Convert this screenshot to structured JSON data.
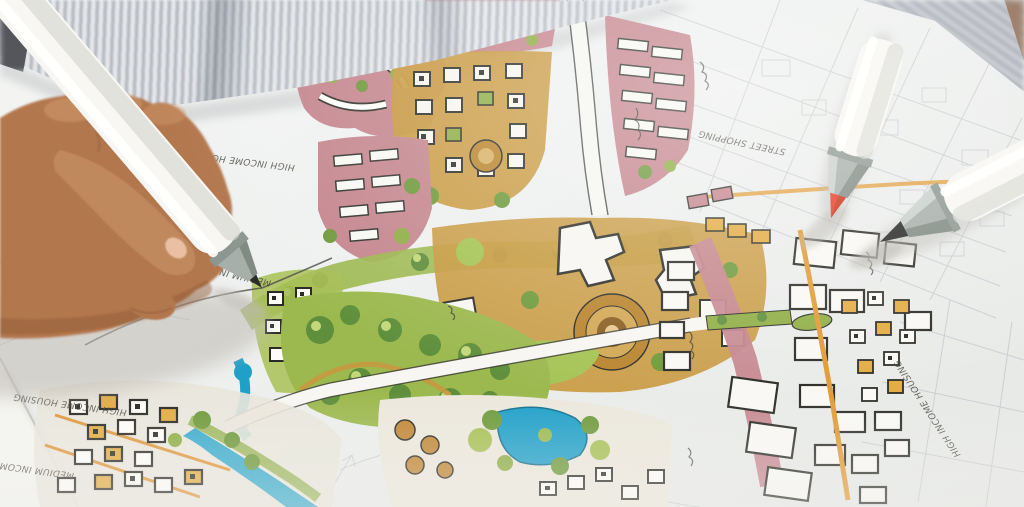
{
  "photo": {
    "scene": "hand sketching with a marker on a colorful hand-drawn urban master plan",
    "labels": [
      {
        "text": "HIGH INCOME HOUSING",
        "location": "left, under hand"
      },
      {
        "text": "MEDIUM INCOME HOUSING",
        "location": "near pen tip"
      },
      {
        "text": "HIGH INCOME HOUSING",
        "location": "bottom left"
      },
      {
        "text": "MEDIUM INCOME HOUSING",
        "location": "bottom left edge"
      },
      {
        "text": "STREET SHOPPING",
        "location": "upper right of plan"
      },
      {
        "text": "HIGH INCOME HOUSING",
        "location": "lower right of plan"
      }
    ],
    "objects": {
      "pen_in_hand": "white marker with grey cone and dark nib",
      "marker_red": "white marker with grey cone and red chisel nib",
      "marker_black": "white marker with grey cone and black chisel nib",
      "shirt": "grey pin-striped shirt",
      "paper": "white sketch paper with faint pencil city grid"
    },
    "colors": {
      "paper": "#eff1ef",
      "shirt_stripe_dark": "#aab0b9",
      "shirt_stripe_light": "#e7e9ec",
      "skin": "#b3774e",
      "marker_body": "#f8f7f3",
      "marker_cone": "#a6afa9",
      "nib_red": "#e63a1f",
      "nib_black": "#262626",
      "ink": "#3a3933",
      "plan_pink": "#c5868e",
      "plan_green": "#9cb94f",
      "plan_green_dark": "#5f8f3c",
      "plan_tan": "#c8993f",
      "plan_water": "#1fa0c8",
      "plan_orange": "#e0902e",
      "pencil": "#bcc0c6"
    }
  }
}
